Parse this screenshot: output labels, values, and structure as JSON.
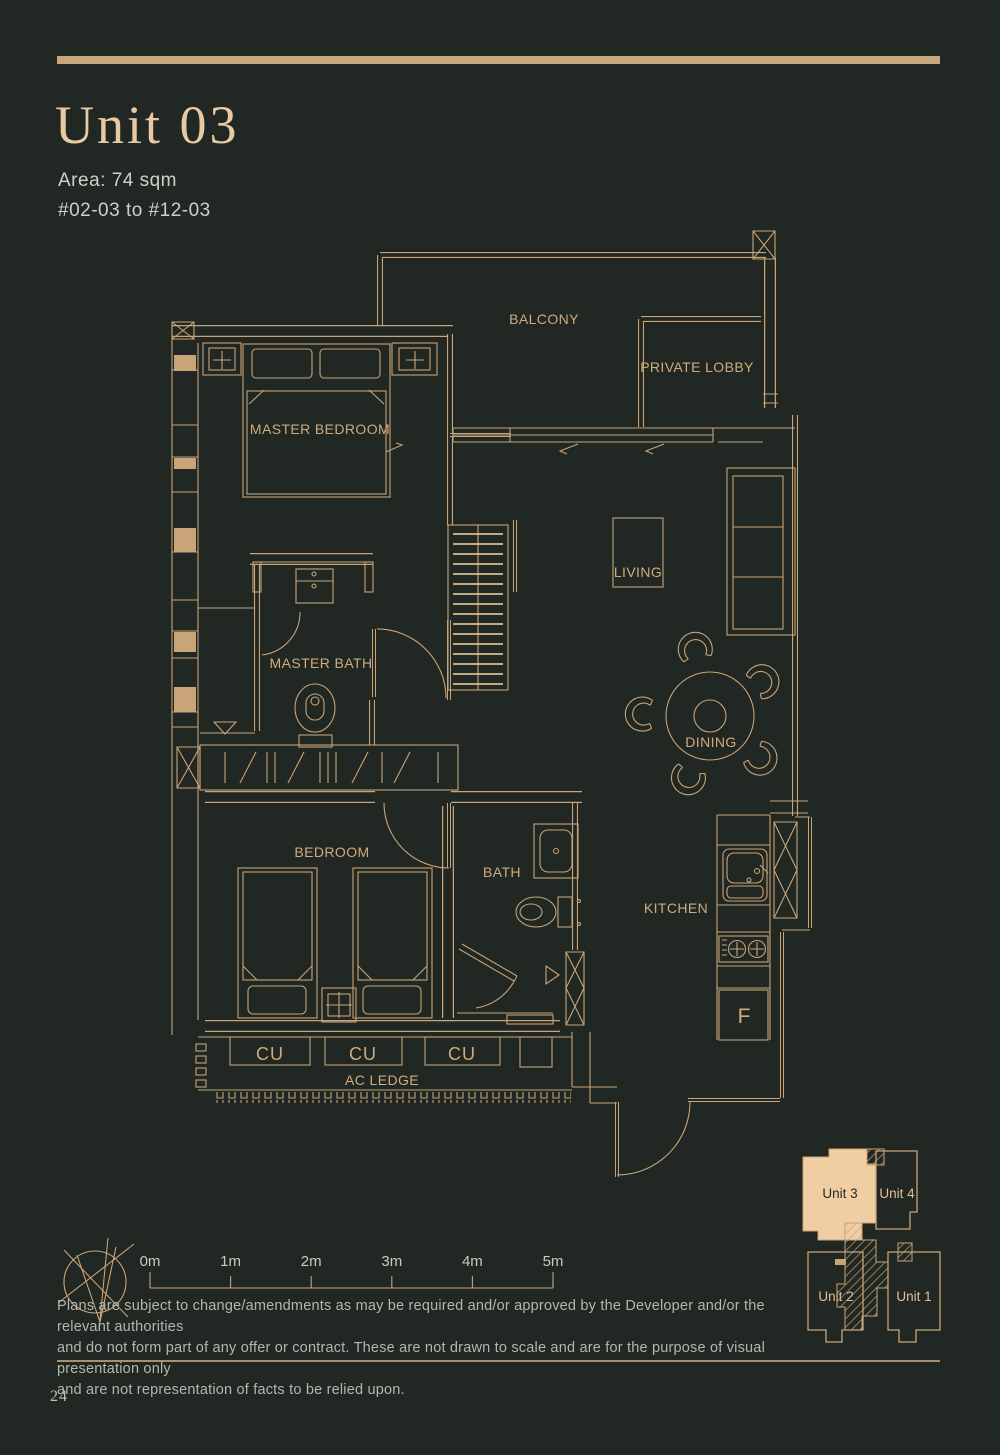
{
  "page": {
    "title": "Unit 03",
    "area_label": "Area: 74 sqm",
    "levels_label": "#02-03 to #12-03",
    "page_number": "24",
    "disclaimer_lines": [
      "Plans are subject to change/amendments as may be required and/or approved by the Developer and/or the relevant authorities",
      "and do not form part of any offer or contract. These are not drawn to scale and are for the purpose of visual presentation only",
      "and are not representation of facts to be relied upon."
    ]
  },
  "colors": {
    "background": "#212722",
    "plan_line": "#c8a478",
    "highlight_fill": "#f0cda2",
    "title_text": "#e8c9a2",
    "body_text": "#ccd1cb",
    "disclaimer_text": "#b2b7b0"
  },
  "floor_plan": {
    "labels": {
      "balcony": "BALCONY",
      "private_lobby": "PRIVATE LOBBY",
      "master_bedroom": "MASTER BEDROOM",
      "master_bath": "MASTER BATH",
      "living": "LIVING",
      "dining": "DINING",
      "bedroom": "BEDROOM",
      "bath": "BATH",
      "kitchen": "KITCHEN",
      "fridge": "F",
      "ac_ledge": "AC LEDGE",
      "cu_1": "CU",
      "cu_2": "CU",
      "cu_3": "CU"
    }
  },
  "scale_bar": {
    "labels": [
      "0m",
      "1m",
      "2m",
      "3m",
      "4m",
      "5m"
    ]
  },
  "key_plan": {
    "unit_3": "Unit 3",
    "unit_4": "Unit 4",
    "unit_2": "Unit 2",
    "unit_1": "Unit 1",
    "highlighted_unit": "Unit 3"
  }
}
